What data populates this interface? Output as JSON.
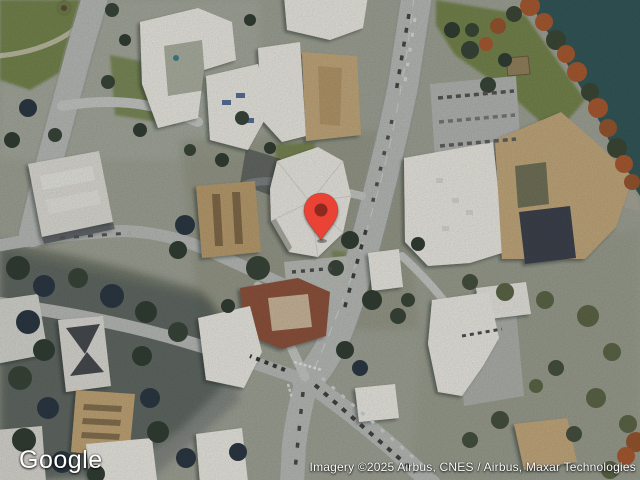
{
  "map": {
    "view_type": "satellite-imagery",
    "marker": {
      "label": "location-pin"
    }
  },
  "footer": {
    "logo": "Google",
    "attribution": "Imagery ©2025 Airbus, CNES / Airbus, Maxar Technologies"
  },
  "colors": {
    "terrain": "#9fa295",
    "water": "#335759",
    "road": "#b7bab7",
    "road_minor": "#c4c7c3",
    "grass": "#75844e",
    "foliage": "#a85a31",
    "roof_white": "#eae8e1",
    "roof_tan": "#c2a87c",
    "solar": "#3c434e",
    "pin": "#EA4335",
    "pin_dot": "#8C2A1F"
  }
}
